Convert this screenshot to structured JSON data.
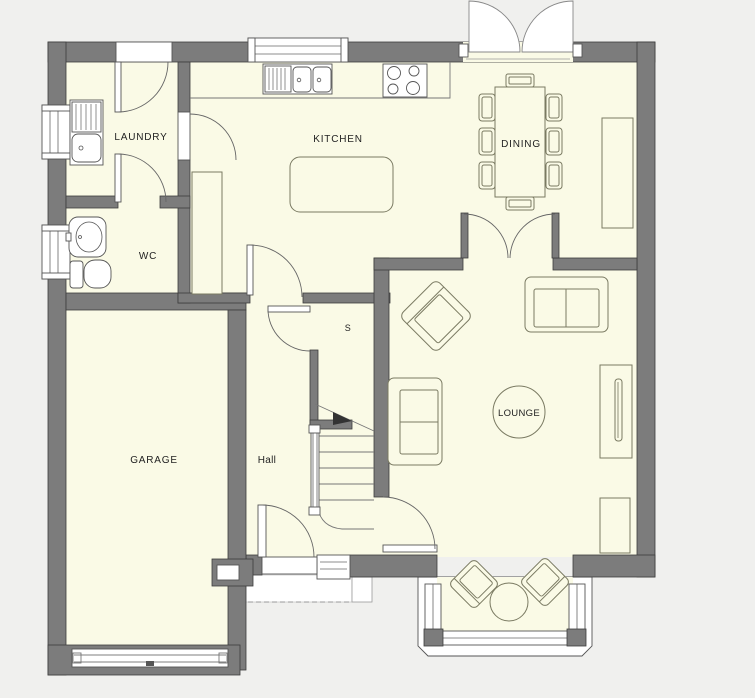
{
  "palette": {
    "background": "#f0f0ee",
    "floor": "#fafae6",
    "wall": "#7c7c7c",
    "wall_outline": "#3d3d3d",
    "window_white": "#ffffff",
    "label_text": "#222222"
  },
  "rooms": {
    "laundry": {
      "label": "LAUNDRY"
    },
    "kitchen": {
      "label": "KITCHEN"
    },
    "dining": {
      "label": "DINING"
    },
    "wc": {
      "label": "WC"
    },
    "store": {
      "label": "S"
    },
    "garage": {
      "label": "GARAGE"
    },
    "hall": {
      "label": "Hall"
    },
    "lounge": {
      "label": "LOUNGE"
    }
  }
}
